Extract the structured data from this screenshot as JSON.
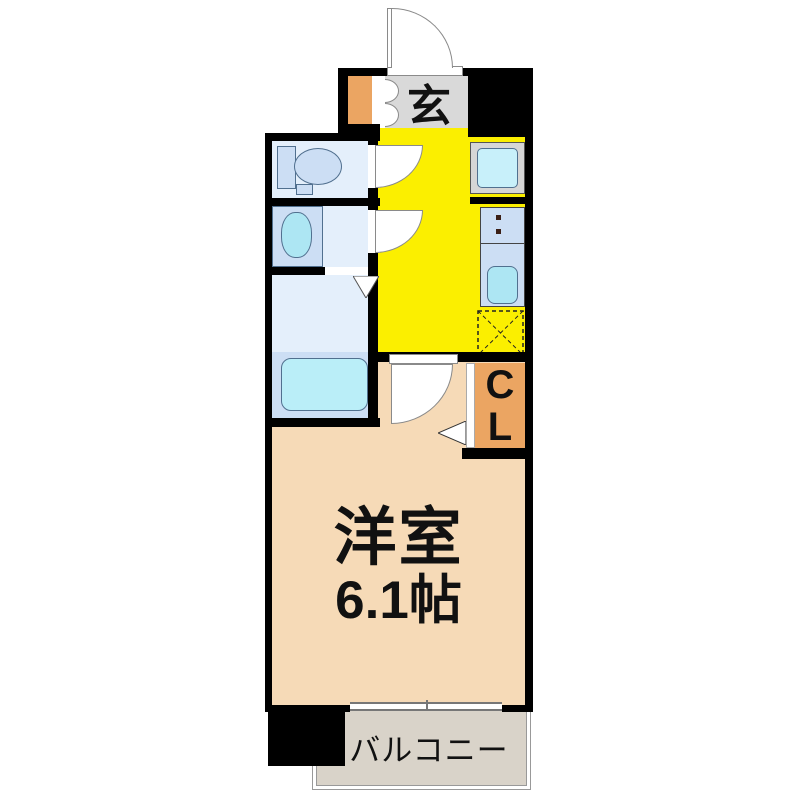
{
  "floorplan": {
    "type": "apartment-1K-floor-plan",
    "labels": {
      "entrance": "玄",
      "closet": [
        "C",
        "L"
      ],
      "main_room_name": "洋室",
      "main_room_size": "6.1帖",
      "balcony": "バルコニー"
    },
    "rooms": [
      "entrance-genkan",
      "toilet-room",
      "washbasin-room",
      "bathroom",
      "kitchen-hallway",
      "closet-CL",
      "western-room-6.1-jo",
      "balcony"
    ],
    "fixtures": [
      "entrance-door-swing",
      "shoe-cabinet-doors",
      "toilet",
      "washbasin",
      "bathtub",
      "washing-machine-space",
      "stove-burners",
      "kitchen-sink",
      "refrigerator-space-dashed",
      "closet-folding-door",
      "bathroom-folding-door",
      "balcony-sliding-window"
    ],
    "palette": {
      "wall_black": "#000000",
      "kitchen_yellow": "#FBEF00",
      "entrance_gray": "#D9D9D9",
      "closet_orange": "#EBA562",
      "room_peach": "#F6DAB7",
      "balcony_beige": "#D9D3C9",
      "wet_room_blue": "#E4EFFB",
      "fixture_blue": "#CCDEF4",
      "water_cyan": "#ADE6F3"
    }
  }
}
